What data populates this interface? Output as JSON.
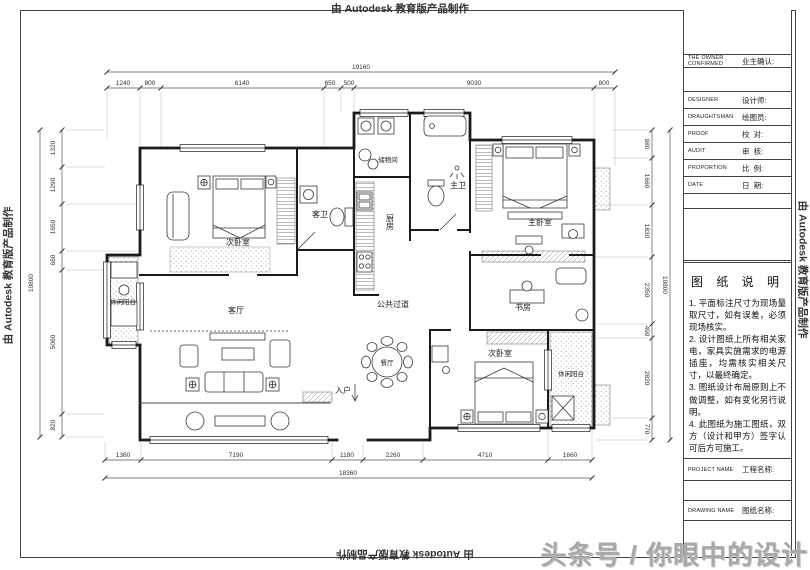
{
  "watermarks": {
    "autodesk": "由 Autodesk 教育版产品制作",
    "toutiao": "头条号 / 你眼中的设计"
  },
  "title_block": {
    "owner": {
      "en": "THE OWNER CONFIRMED",
      "zh": "业主确认:"
    },
    "rows": [
      {
        "en": "DESIGNER",
        "zh": "设计师:"
      },
      {
        "en": "DRAUGHTSMAN",
        "zh": "绘图员:"
      },
      {
        "en": "PROOF",
        "zh": "校  对:"
      },
      {
        "en": "AUDIT",
        "zh": "审  核:"
      },
      {
        "en": "PROPORTION",
        "zh": "比  例:"
      },
      {
        "en": "DATE",
        "zh": "日  期:"
      }
    ],
    "notes_title": "图 纸 说 明",
    "notes": [
      "1. 平面标注尺寸为现场量取尺寸，如有误差，必须现场核实。",
      "2. 设计图纸上所有相关家电，家具实施需求的电源插座，均需核实相关尺寸，以最终确定。",
      "3. 图纸设计布局原则上不做调整，如有变化另行说明。",
      "4. 此图纸为施工图纸，双方（设计和甲方）签字认可后方可施工。"
    ],
    "project": {
      "en": "PROJECT NAME",
      "zh": "工程名称:"
    },
    "drawing": {
      "en": "DRAWING NAME",
      "zh": "图纸名称:"
    }
  },
  "rooms": {
    "bedroom_tl": "次卧室",
    "guest_bath": "客卫",
    "storage": "储物间",
    "kitchen": "厨房",
    "master_bath": "主卫",
    "master_bedroom": "主卧室",
    "study": "书房",
    "corridor": "公共过道",
    "living": "客厅",
    "dining": "餐厅",
    "entry": "入户",
    "bedroom_br": "次卧室",
    "balcony_left": "休闲阳台",
    "balcony_right": "休闲阳台"
  },
  "dimensions": {
    "top": {
      "total": "19160",
      "segments": [
        "1240",
        "800",
        "6140",
        "650",
        "500",
        "9030",
        "800"
      ]
    },
    "bottom": {
      "total": "18360",
      "segments": [
        "1360",
        "7190",
        "1180",
        "2260",
        "4710",
        "1660"
      ]
    },
    "left": {
      "total": "10800",
      "segments": [
        "1320",
        "1290",
        "1650",
        "660",
        "5060",
        "820"
      ]
    },
    "right": {
      "total": "10800",
      "segments": [
        "980",
        "1660",
        "1830",
        "2350",
        "490",
        "2820",
        "770"
      ]
    }
  }
}
